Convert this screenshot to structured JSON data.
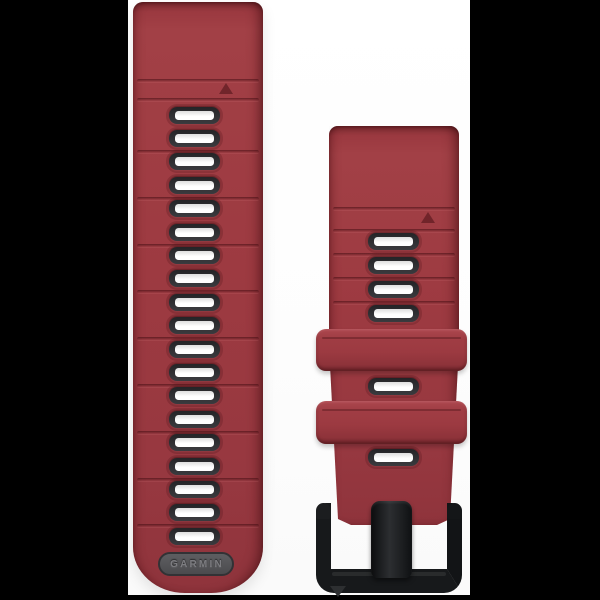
{
  "page": {
    "background_color": "#000000",
    "photo_background_color": "#ffffff"
  },
  "product": {
    "item": "Red silicone quick-release watch band with graphite hole trim and black metal buckle",
    "brand": "GARMIN",
    "band_color_hex": "#9d3a41",
    "hole_trim_color_hex": "#2c2c2f",
    "hole_fill_color_hex": "#ffffff",
    "logo_pill_color_hex": "#505053",
    "buckle_color_hex": "#17191b"
  },
  "left_strap": {
    "logo_text": "GARMIN",
    "hole_count": 19,
    "top_ridge_count": 2,
    "pair_ridge_count": 9,
    "has_alignment_triangle": true
  },
  "right_strap": {
    "upper_hole_count": 4,
    "mid_hole_count": 1,
    "lower_hole_count": 1,
    "keeper_count": 2,
    "ridge_count": 5,
    "has_alignment_triangle": true,
    "has_buckle": true,
    "has_prong": true
  },
  "watermark": {
    "shape": "small dark down-pointing triangle near buckle bottom-left"
  }
}
